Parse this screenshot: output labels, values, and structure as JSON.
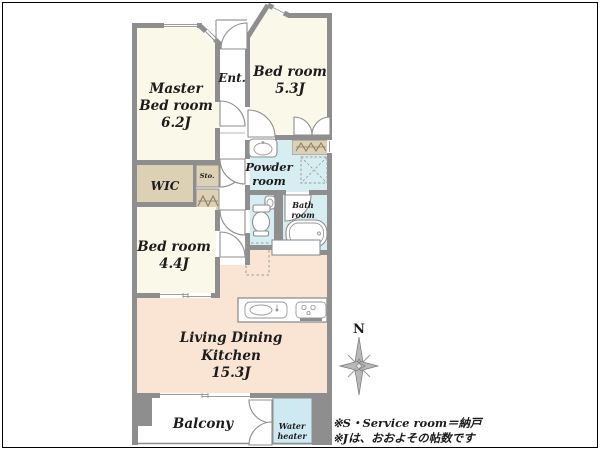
{
  "plan": {
    "rooms": {
      "master_bedroom": {
        "line1": "Master",
        "line2": "Bed room",
        "size": "6.2J"
      },
      "entrance": {
        "label": "Ent."
      },
      "bedroom_2": {
        "label": "Bed room",
        "size": "5.3J"
      },
      "wic": {
        "label": "WIC"
      },
      "storage": {
        "label": "Sto."
      },
      "powder_room": {
        "line1": "Powder",
        "line2": "room"
      },
      "bath_room": {
        "line1": "Bath",
        "line2": "room"
      },
      "bedroom_3": {
        "label": "Bed room",
        "size": "4.4J"
      },
      "ldk": {
        "line1": "Living Dining",
        "line2": "Kitchen",
        "size": "15.3J"
      },
      "balcony": {
        "label": "Balcony"
      },
      "water_heater": {
        "line1": "Water",
        "line2": "heater"
      }
    },
    "compass": {
      "label": "N"
    },
    "notes": {
      "line1": "※S・Service room＝納戸",
      "line2": "※Jは、おおよその帖数です"
    },
    "colors": {
      "wall": "#8E8E8E",
      "room_floor": "#FAF8E8",
      "closet": "#DCD1B5",
      "wet": "#D6EDF2",
      "water_heater": "#CFE9F2",
      "ldk": "#FAE4D3",
      "text": "#1C1C1C",
      "frame": "#000000"
    }
  }
}
